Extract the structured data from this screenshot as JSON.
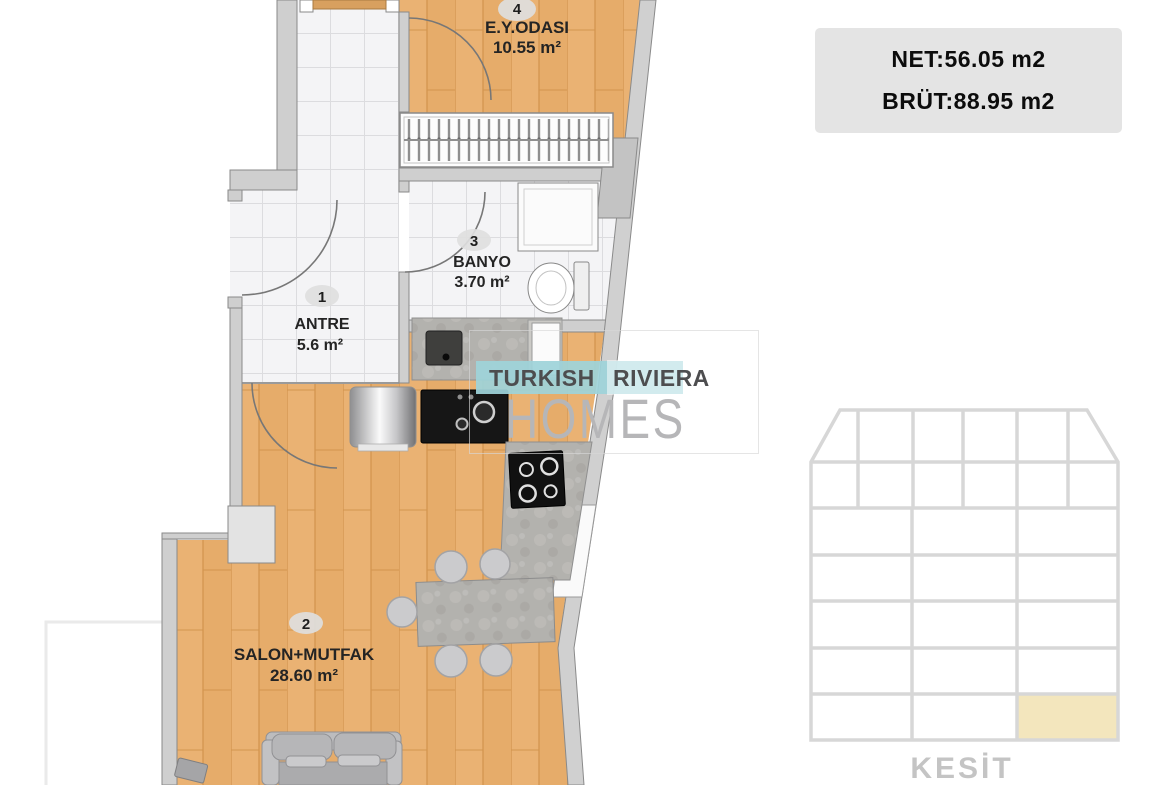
{
  "header_badge": {
    "net_label": "NET:56.05 m2",
    "brut_label": "BRÜT:88.95 m2"
  },
  "watermark": {
    "word1": "TURKISH",
    "word2": "RIVIERA",
    "word3": "HOMES"
  },
  "floor_plan": {
    "rooms": [
      {
        "number": "1",
        "name": "ANTRE",
        "area": "5.6 m²"
      },
      {
        "number": "2",
        "name": "SALON+MUTFAK",
        "area": "28.60 m²"
      },
      {
        "number": "3",
        "name": "BANYO",
        "area": "3.70 m²"
      },
      {
        "number": "4",
        "name": "E.Y.ODASI",
        "area": "10.55 m²"
      }
    ]
  },
  "section_diagram": {
    "label": "KESİT",
    "rows": 7,
    "upper_columns": 6,
    "lower_columns": 3,
    "highlighted_cell": "bottom-right",
    "highlight_color": "#f3e6bd"
  },
  "colors": {
    "wood_floor": "#eab273",
    "tile_floor": "#f4f4f6",
    "wall": "#cfcfcf",
    "badge_bg": "#e4e4e4",
    "watermark_teal": "#9ed3d9",
    "section_grid_line": "#d7d7d7"
  }
}
